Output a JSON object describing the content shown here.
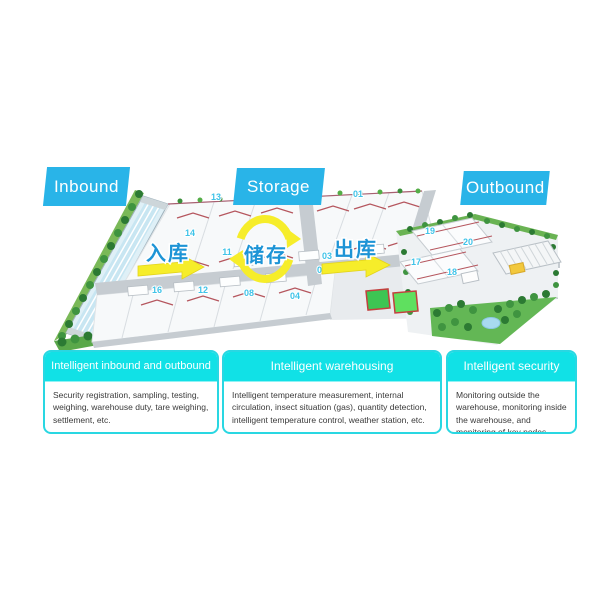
{
  "flow_labels": {
    "inbound": "Inbound",
    "storage": "Storage",
    "outbound": "Outbound"
  },
  "map": {
    "flow_cn": {
      "inbound": "入库",
      "storage": "储存",
      "outbound": "出库"
    },
    "numbers": [
      "13",
      "01",
      "14",
      "11",
      "03",
      "05",
      "16",
      "12",
      "08",
      "04",
      "19",
      "20",
      "17",
      "18"
    ],
    "colors": {
      "label_blue": "#29b4e8",
      "card_cyan": "#11e1e6",
      "card_border": "#29d7e2",
      "arrow_yellow": "#f6ed2a",
      "flow_text_blue": "#1d94d6",
      "number_cyan": "#3fc3e8",
      "grass_green": "#63b755",
      "tree_green": "#2c7a33",
      "road_gray": "#c6ccd1",
      "roof_ridge_red": "#b5565e",
      "pond_blue": "#a8daf0",
      "court_green": "#3dc553",
      "court_border_red": "#c2403e",
      "greenhouse_blue": "#c8e6f2",
      "building_yellow": "#f2c83c"
    }
  },
  "cards": [
    {
      "title": "Intelligent inbound and outbound",
      "body": "Security registration, sampling, testing, weighing, warehouse duty, tare weighing, settlement, etc."
    },
    {
      "title": "Intelligent warehousing",
      "body": "Intelligent temperature measurement, internal circulation, insect situation (gas), quantity detection, intelligent temperature control, weather station, etc."
    },
    {
      "title": "Intelligent security",
      "body": "Monitoring outside the warehouse, monitoring inside the warehouse, and monitoring of key nodes."
    }
  ]
}
